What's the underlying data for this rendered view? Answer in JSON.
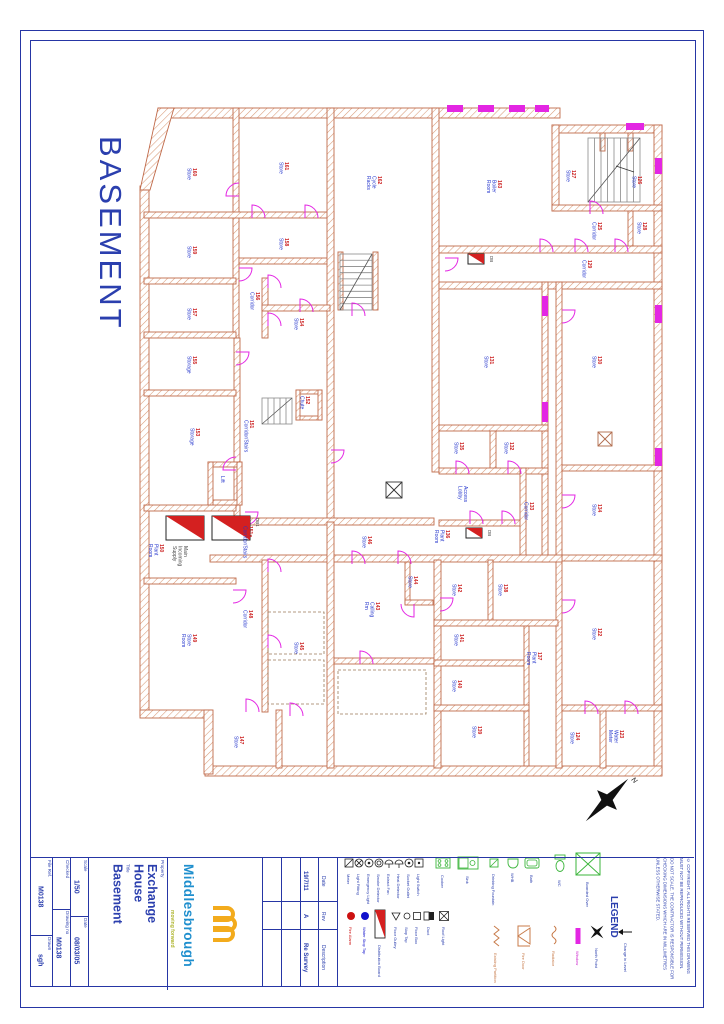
{
  "sheet": {
    "big_title": "BASEMENT"
  },
  "colors": {
    "frame_blue": "#2636a5",
    "text_blue": "#2b3fae",
    "room_red": "#cc2222",
    "room_blue": "#2233cc",
    "wall_stroke": "#c06a4a",
    "wall_hatch": "#d89a78",
    "door_magenta": "#e326e3",
    "db_red": "#d42020",
    "fixture_green": "#3bb53b",
    "logo_blue": "#1f8fce",
    "logo_yellow": "#f3ab1c"
  },
  "title_block": {
    "file_ref_label": "File Ref.",
    "file_ref": "M0138",
    "drawn_label": "Drawn",
    "drawn": "sgh",
    "checked_label": "Checked",
    "checked": "",
    "drawing_no_label": "Drawing no",
    "drawing_no": "M0138",
    "scale_label": "Scale",
    "scale": "1/50",
    "date_label": "Date",
    "date": "08/03/05",
    "property_label": "Property",
    "property_line1": "Exchange",
    "property_line2": "House",
    "title_label": "Title",
    "title_value": "Basement",
    "logo": {
      "name": "Middlesbrough",
      "tagline": "moving forward"
    },
    "revisions": {
      "date_header": "Date",
      "rev_header": "Rev",
      "description_header": "Description",
      "rows": [
        {
          "date": "19/7/11",
          "rev": "A",
          "description": "Re Survey"
        }
      ]
    },
    "legend_title": "LEGEND",
    "copyright": "© COPYRIGHT. ALL RIGHTS RESERVED THIS DRAWING MUST NOT BE REPRODUCED WITHOUT PERMISSION.",
    "disclaimer": "DO NOT SCALE. THE CONTRACTOR IS RESPONSIBLE FOR CHECKING DIMENSIONS WHICH ARE IN MILLIMETRES UNLESS OTHERWISE STATED."
  },
  "plan": {
    "walls": [
      [
        158,
        108,
        402,
        10
      ],
      [
        552,
        125,
        110,
        8
      ],
      [
        654,
        125,
        8,
        650
      ],
      [
        205,
        766,
        457,
        10
      ],
      [
        140,
        186,
        9,
        530
      ],
      [
        140,
        710,
        72,
        8
      ],
      [
        204,
        710,
        9,
        64
      ],
      [
        233,
        108,
        6,
        230
      ],
      [
        144,
        212,
        190,
        6
      ],
      [
        144,
        278,
        92,
        6
      ],
      [
        239,
        258,
        92,
        6
      ],
      [
        327,
        108,
        7,
        414
      ],
      [
        432,
        108,
        7,
        364
      ],
      [
        439,
        246,
        223,
        7
      ],
      [
        552,
        125,
        7,
        86
      ],
      [
        552,
        205,
        110,
        6
      ],
      [
        439,
        282,
        223,
        7
      ],
      [
        542,
        282,
        6,
        280
      ],
      [
        556,
        282,
        6,
        486
      ],
      [
        439,
        425,
        109,
        6
      ],
      [
        562,
        465,
        100,
        6
      ],
      [
        490,
        431,
        6,
        40
      ],
      [
        439,
        468,
        109,
        6
      ],
      [
        562,
        555,
        100,
        6
      ],
      [
        439,
        520,
        87,
        6
      ],
      [
        520,
        468,
        6,
        92
      ],
      [
        234,
        338,
        6,
        180
      ],
      [
        144,
        332,
        92,
        6
      ],
      [
        144,
        390,
        92,
        6
      ],
      [
        144,
        505,
        92,
        6
      ],
      [
        144,
        578,
        92,
        6
      ],
      [
        262,
        278,
        6,
        60
      ],
      [
        262,
        305,
        68,
        6
      ],
      [
        239,
        518,
        195,
        7
      ],
      [
        210,
        555,
        352,
        7
      ],
      [
        262,
        560,
        6,
        152
      ],
      [
        327,
        522,
        7,
        246
      ],
      [
        405,
        562,
        5,
        42
      ],
      [
        405,
        600,
        28,
        5
      ],
      [
        334,
        658,
        100,
        6
      ],
      [
        434,
        560,
        7,
        208
      ],
      [
        488,
        560,
        5,
        66
      ],
      [
        434,
        620,
        124,
        6
      ],
      [
        434,
        660,
        95,
        6
      ],
      [
        524,
        626,
        5,
        140
      ],
      [
        434,
        705,
        95,
        6
      ],
      [
        276,
        710,
        6,
        58
      ],
      [
        600,
        710,
        6,
        58
      ],
      [
        562,
        705,
        100,
        6
      ],
      [
        373,
        252,
        5,
        58
      ],
      [
        338,
        252,
        5,
        58
      ],
      [
        628,
        211,
        5,
        35
      ],
      [
        600,
        133,
        5,
        18
      ],
      [
        628,
        133,
        5,
        18
      ],
      [
        208,
        462,
        34,
        5
      ],
      [
        208,
        500,
        34,
        5
      ],
      [
        208,
        462,
        5,
        43
      ],
      [
        237,
        462,
        5,
        43
      ],
      [
        296,
        390,
        26,
        4
      ],
      [
        296,
        416,
        26,
        4
      ],
      [
        296,
        390,
        4,
        30
      ],
      [
        318,
        390,
        4,
        30
      ]
    ],
    "polys": [
      "158,108 174,108 150,190 140,190"
    ],
    "rooms": [
      {
        "num": "160",
        "name": "Store",
        "x": 193,
        "y": 168
      },
      {
        "num": "161",
        "name": "Store",
        "x": 285,
        "y": 162
      },
      {
        "num": "159",
        "name": "Store",
        "x": 193,
        "y": 246
      },
      {
        "num": "158",
        "name": "Store",
        "x": 285,
        "y": 238
      },
      {
        "num": "162",
        "name": "Cycle Racks",
        "lines": [
          "Cycle",
          "Racks"
        ],
        "x": 378,
        "y": 176
      },
      {
        "num": "163",
        "name": "Boiler Room",
        "lines": [
          "Boiler",
          "Room"
        ],
        "x": 498,
        "y": 180
      },
      {
        "num": "127",
        "name": "Store",
        "x": 572,
        "y": 170
      },
      {
        "num": "126",
        "name": "Store",
        "x": 638,
        "y": 176
      },
      {
        "num": "125",
        "name": "Corridor",
        "x": 598,
        "y": 222
      },
      {
        "num": "128",
        "name": "Store",
        "x": 643,
        "y": 222
      },
      {
        "num": "129",
        "name": "Corridor",
        "x": 588,
        "y": 260
      },
      {
        "num": "157",
        "name": "Store",
        "x": 193,
        "y": 308
      },
      {
        "num": "156",
        "name": "Corridor",
        "x": 256,
        "y": 292
      },
      {
        "num": "154",
        "name": "Store",
        "x": 300,
        "y": 318
      },
      {
        "num": "155",
        "name": "Storage",
        "x": 193,
        "y": 356
      },
      {
        "num": "153",
        "name": "Storage",
        "x": 196,
        "y": 428
      },
      {
        "num": "151",
        "name": "Corridor/Stairs",
        "x": 250,
        "y": 420
      },
      {
        "num": "152",
        "name": "Chute",
        "x": 306,
        "y": 396
      },
      {
        "num": "",
        "name": "Lift",
        "x": 221,
        "y": 476
      },
      {
        "num": "151a",
        "name": "Corridor/Stairs",
        "x": 249,
        "y": 526
      },
      {
        "num": "150",
        "name": "Plant Room",
        "lines": [
          "Plant",
          "Room"
        ],
        "x": 160,
        "y": 544
      },
      {
        "num": "",
        "name": "Main Incoming Supply",
        "lines": [
          "Main",
          "Incoming",
          "Supply"
        ],
        "x": 184,
        "y": 546,
        "color": "#444444"
      },
      {
        "num": "149",
        "name": "Store Room",
        "lines": [
          "Store",
          "Room"
        ],
        "x": 193,
        "y": 634
      },
      {
        "num": "148",
        "name": "Corridor",
        "x": 249,
        "y": 610
      },
      {
        "num": "145",
        "name": "Store",
        "x": 300,
        "y": 642
      },
      {
        "num": "146",
        "name": "Store",
        "x": 368,
        "y": 536
      },
      {
        "num": "144",
        "name": "Store",
        "x": 414,
        "y": 576
      },
      {
        "num": "143",
        "name": "Calling Rm",
        "lines": [
          "Calling",
          "Rm"
        ],
        "x": 376,
        "y": 602
      },
      {
        "num": "142",
        "name": "Store",
        "x": 458,
        "y": 584
      },
      {
        "num": "138",
        "name": "Store",
        "x": 504,
        "y": 584
      },
      {
        "num": "141",
        "name": "Store",
        "x": 460,
        "y": 634
      },
      {
        "num": "137",
        "name": "Plant Room",
        "lines": [
          "Plant",
          "Room"
        ],
        "x": 538,
        "y": 652
      },
      {
        "num": "140",
        "name": "Store",
        "x": 458,
        "y": 680
      },
      {
        "num": "139",
        "name": "Store",
        "x": 478,
        "y": 726
      },
      {
        "num": "147",
        "name": "Store",
        "x": 240,
        "y": 736
      },
      {
        "num": "135",
        "name": "Store",
        "x": 460,
        "y": 442
      },
      {
        "num": "132",
        "name": "Store",
        "x": 510,
        "y": 442
      },
      {
        "num": "",
        "name": "Access Lobby",
        "lines": [
          "Access",
          "Lobby"
        ],
        "x": 464,
        "y": 486
      },
      {
        "num": "133",
        "name": "Corridor",
        "x": 530,
        "y": 502
      },
      {
        "num": "136",
        "name": "Plant Room",
        "lines": [
          "Plant",
          "Room"
        ],
        "x": 446,
        "y": 530
      },
      {
        "num": "131",
        "name": "Store",
        "x": 490,
        "y": 356
      },
      {
        "num": "130",
        "name": "Store",
        "x": 598,
        "y": 356
      },
      {
        "num": "134",
        "name": "Store",
        "x": 598,
        "y": 504
      },
      {
        "num": "122",
        "name": "Store",
        "x": 598,
        "y": 628
      },
      {
        "num": "124",
        "name": "Store",
        "x": 576,
        "y": 732
      },
      {
        "num": "123",
        "name": "Water Meter",
        "lines": [
          "Water",
          "Meter"
        ],
        "x": 620,
        "y": 730
      }
    ],
    "doors": [
      [
        239,
        196,
        270
      ],
      [
        252,
        218,
        0
      ],
      [
        305,
        218,
        0
      ],
      [
        239,
        268,
        90
      ],
      [
        268,
        288,
        0
      ],
      [
        268,
        326,
        0
      ],
      [
        236,
        352,
        90
      ],
      [
        300,
        312,
        0
      ],
      [
        236,
        470,
        270
      ],
      [
        245,
        512,
        90
      ],
      [
        268,
        572,
        0
      ],
      [
        268,
        648,
        0
      ],
      [
        233,
        590,
        90
      ],
      [
        246,
        712,
        0
      ],
      [
        290,
        716,
        0
      ],
      [
        352,
        564,
        0
      ],
      [
        398,
        564,
        0
      ],
      [
        414,
        604,
        180
      ],
      [
        360,
        664,
        0
      ],
      [
        440,
        598,
        90
      ],
      [
        470,
        524,
        0
      ],
      [
        502,
        524,
        0
      ],
      [
        456,
        474,
        0
      ],
      [
        508,
        474,
        0
      ],
      [
        562,
        310,
        90
      ],
      [
        562,
        495,
        90
      ],
      [
        562,
        600,
        90
      ],
      [
        575,
        252,
        0
      ],
      [
        615,
        252,
        0
      ],
      [
        590,
        214,
        0
      ],
      [
        585,
        714,
        0
      ],
      [
        625,
        714,
        0
      ],
      [
        540,
        252,
        0
      ],
      [
        445,
        258,
        90
      ],
      [
        352,
        316,
        0
      ],
      [
        331,
        450,
        90
      ]
    ],
    "windows": [
      [
        447,
        105,
        16,
        7
      ],
      [
        478,
        105,
        16,
        7
      ],
      [
        509,
        105,
        16,
        7
      ],
      [
        535,
        105,
        14,
        7
      ],
      [
        626,
        123,
        18,
        7
      ],
      [
        655,
        158,
        7,
        16
      ],
      [
        655,
        305,
        7,
        18
      ],
      [
        655,
        448,
        7,
        18
      ],
      [
        542,
        296,
        6,
        20
      ],
      [
        542,
        402,
        6,
        20
      ]
    ],
    "stairs": [
      {
        "x": 588,
        "y": 138,
        "w": 52,
        "h": 64,
        "dir": "v",
        "n": 8
      },
      {
        "x": 340,
        "y": 254,
        "w": 32,
        "h": 56,
        "dir": "h",
        "n": 9
      },
      {
        "x": 262,
        "y": 398,
        "w": 30,
        "h": 26,
        "dir": "v",
        "n": 5
      }
    ],
    "db_boards": [
      {
        "x": 166,
        "y": 516,
        "w": 38,
        "h": 24,
        "label": ""
      },
      {
        "x": 212,
        "y": 516,
        "w": 38,
        "h": 24,
        "label": "DB1"
      },
      {
        "x": 466,
        "y": 528,
        "w": 16,
        "h": 10,
        "label": "DB"
      },
      {
        "x": 468,
        "y": 254,
        "w": 16,
        "h": 10,
        "label": "DB"
      }
    ],
    "crossed_squares": [
      {
        "x": 386,
        "y": 482,
        "s": 16,
        "color": "#333333"
      },
      {
        "x": 598,
        "y": 432,
        "s": 14,
        "color": "#b06a4a"
      }
    ],
    "dashed_rects": [
      [
        268,
        612,
        56,
        42
      ],
      [
        268,
        660,
        56,
        44
      ],
      [
        338,
        670,
        88,
        44
      ]
    ],
    "leaders": [
      [
        634,
        172,
        616,
        166
      ]
    ],
    "north": {
      "x": 607,
      "y": 800,
      "label": "N"
    }
  },
  "legend": {
    "items": [
      {
        "type": "sq-slash",
        "x": 349,
        "y": 863,
        "label": "Meter"
      },
      {
        "type": "circ-x",
        "x": 359,
        "y": 863,
        "label": "Light Fitting"
      },
      {
        "type": "circ-dot",
        "x": 369,
        "y": 863,
        "label": "Emergency Light"
      },
      {
        "type": "circ-ring",
        "x": 379,
        "y": 863,
        "label": "Smoke Detector"
      },
      {
        "type": "semi",
        "x": 389,
        "y": 863,
        "label": "Extract Fan"
      },
      {
        "type": "semi",
        "x": 399,
        "y": 863,
        "label": "Heat Detector"
      },
      {
        "type": "circ-dot",
        "x": 409,
        "y": 863,
        "label": "Socket Outlet"
      },
      {
        "type": "sq-dot",
        "x": 419,
        "y": 863,
        "label": "Light Switch"
      },
      {
        "type": "cooker",
        "x": 443,
        "y": 863,
        "label": "Cooker"
      },
      {
        "type": "sink",
        "x": 468,
        "y": 863,
        "label": "Sink"
      },
      {
        "type": "drain",
        "x": 494,
        "y": 863,
        "label": "Drinking Fountain"
      },
      {
        "type": "basin",
        "x": 513,
        "y": 863,
        "label": "WHB"
      },
      {
        "type": "bath",
        "x": 532,
        "y": 863,
        "label": "Bath"
      },
      {
        "type": "wc",
        "x": 560,
        "y": 864,
        "label": "WC"
      },
      {
        "type": "boarded",
        "x": 588,
        "y": 864,
        "label": "Boarded Over"
      },
      {
        "type": "red-dot",
        "x": 351,
        "y": 916,
        "label": "Fire Alarm",
        "lc": "#cc1111"
      },
      {
        "type": "blue-dot",
        "x": 365,
        "y": 916,
        "label": "Water Stop Tap",
        "lc": "#1111cc"
      },
      {
        "type": "db-sym",
        "x": 380,
        "y": 912,
        "label": "Distribution Board"
      },
      {
        "type": "tri",
        "x": 396,
        "y": 916,
        "label": "Floor Gulley"
      },
      {
        "type": "circ",
        "x": 407,
        "y": 916,
        "label": "Stop Tap"
      },
      {
        "type": "sq",
        "x": 417,
        "y": 916,
        "label": "Floor Box"
      },
      {
        "type": "sq-pair",
        "x": 429,
        "y": 916,
        "label": "Duct"
      },
      {
        "type": "sq-cross",
        "x": 444,
        "y": 916,
        "label": "Roof Light"
      },
      {
        "type": "zigzag",
        "x": 496,
        "y": 936,
        "label": "Existing Partition",
        "lc": "#c87b4a"
      },
      {
        "type": "firedoor",
        "x": 524,
        "y": 936,
        "label": "Fire Door",
        "lc": "#c87b4a"
      },
      {
        "type": "radiator",
        "x": 554,
        "y": 936,
        "label": "Radiator",
        "lc": "#c87b4a"
      },
      {
        "type": "window-sym",
        "x": 578,
        "y": 936,
        "label": "Window",
        "lc": "#cc22cc"
      },
      {
        "type": "north-sym",
        "x": 597,
        "y": 932,
        "label": "North Point"
      },
      {
        "type": "arrow-sym",
        "x": 626,
        "y": 932,
        "label": "Change in Level"
      }
    ]
  }
}
